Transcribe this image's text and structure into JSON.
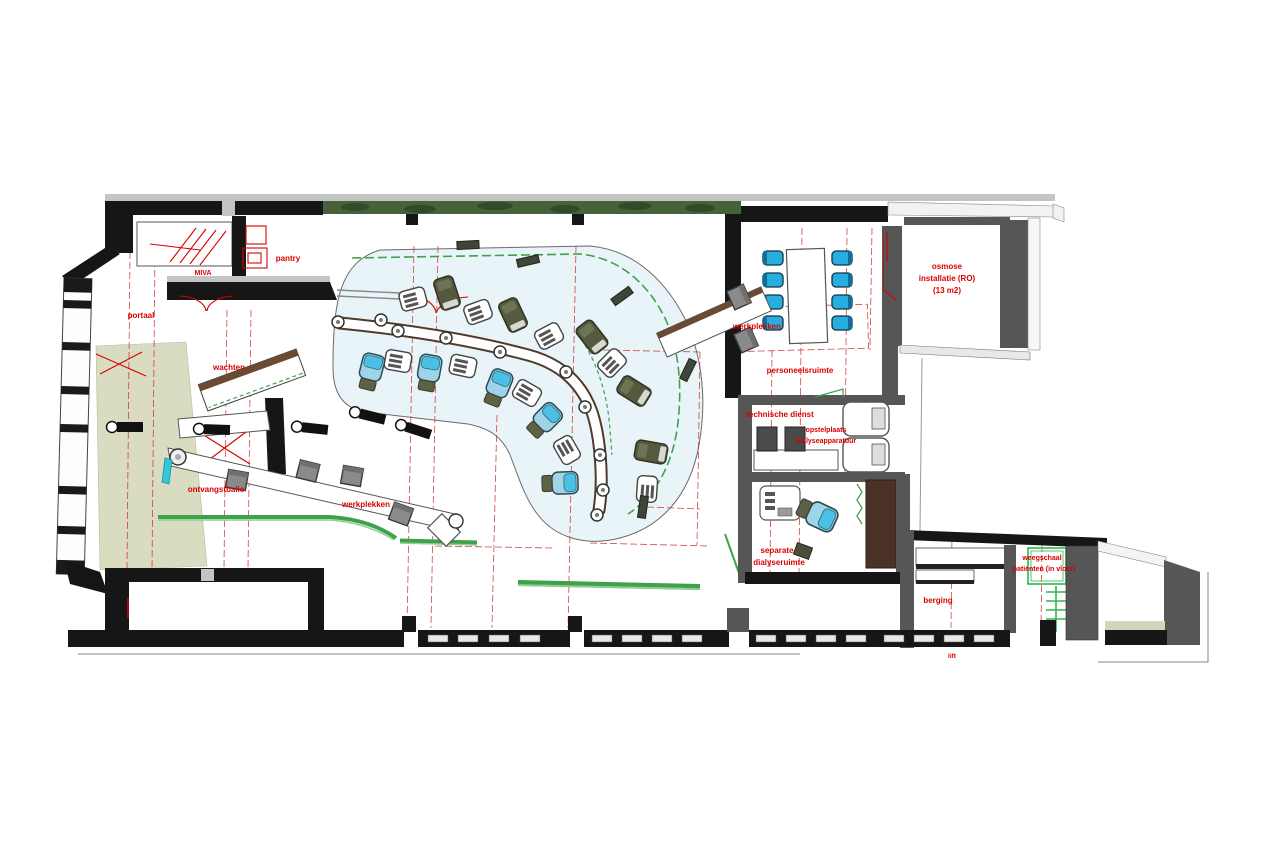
{
  "plan": {
    "labels": {
      "pantry": "pantry",
      "miva": "MIVA",
      "portaal": "portaal",
      "wachten": "wachten",
      "ontvangstbalie": "ontvangstbalie",
      "werkplekken_hal": "werkplekken",
      "werkplekken_overleg": "werkplekken",
      "personeelsruimte": "personeelsruimte",
      "osmose_1": "osmose",
      "osmose_2": "installatie (RO)",
      "osmose_3": "(13 m2)",
      "technische_dienst": "technische dienst",
      "opstelplaats_1": "opstelplaats",
      "opstelplaats_2": "dialyseapparatuur",
      "separate_1": "separate",
      "separate_2": "dialyseruimte",
      "berging": "berging",
      "weegschaal_1": "weegschaal",
      "weegschaal_2": "patiënten (in vloer)",
      "lift": "lift"
    },
    "colors": {
      "label_red": "#d90000",
      "wall_dark": "#161616",
      "wall_gray": "#565656",
      "hall_floor_blue": "#e9f4f9",
      "waiting_floor_beige": "#dadcc2",
      "green_line": "#3fa14a",
      "hedge_green": "#47613a",
      "counter_wood": "#503a28",
      "chair_cyan": "#25aede",
      "dialysis_seat_blue": "#9fd3e8",
      "dialysis_pillow_cyan": "#4cc0e4",
      "recliner_olive": "#555a3e"
    }
  }
}
